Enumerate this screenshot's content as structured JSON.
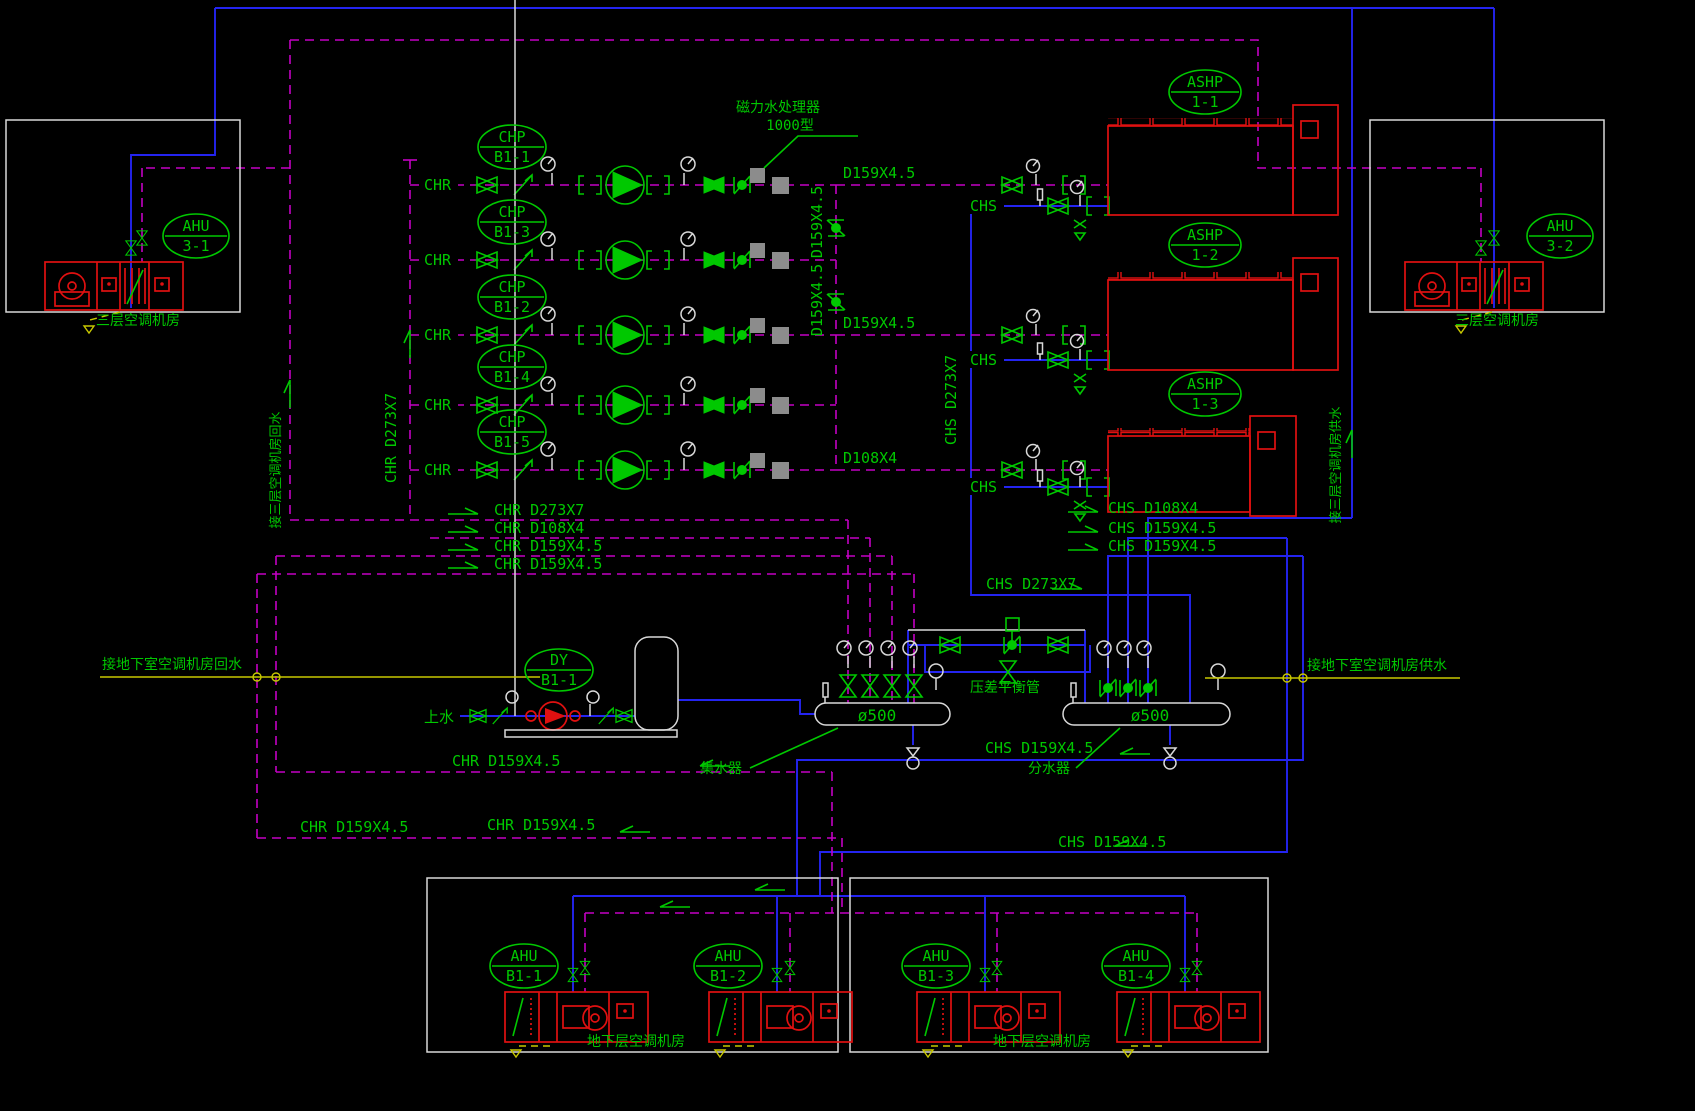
{
  "colors": {
    "background": "#000000",
    "return_pipe_chr": "#C400C4",
    "supply_pipe_chs": "#2424F0",
    "symbols_text": "#00C800",
    "equipment": "#E01010",
    "outline_white": "#D9D9D9",
    "drain_yellow": "#C8C800",
    "processor_gray": "#8C8C8C"
  },
  "tags": {
    "chp": [
      {
        "top": "CHP",
        "bot": "B1-1"
      },
      {
        "top": "CHP",
        "bot": "B1-3"
      },
      {
        "top": "CHP",
        "bot": "B1-2"
      },
      {
        "top": "CHP",
        "bot": "B1-4"
      },
      {
        "top": "CHP",
        "bot": "B1-5"
      }
    ],
    "ashp": [
      {
        "top": "ASHP",
        "bot": "1-1"
      },
      {
        "top": "ASHP",
        "bot": "1-2"
      },
      {
        "top": "ASHP",
        "bot": "1-3"
      }
    ],
    "ahu3": [
      {
        "top": "AHU",
        "bot": "3-1"
      },
      {
        "top": "AHU",
        "bot": "3-2"
      }
    ],
    "ahub": [
      {
        "top": "AHU",
        "bot": "B1-1"
      },
      {
        "top": "AHU",
        "bot": "B1-2"
      },
      {
        "top": "AHU",
        "bot": "B1-3"
      },
      {
        "top": "AHU",
        "bot": "B1-4"
      }
    ],
    "dy": {
      "top": "DY",
      "bot": "B1-1"
    }
  },
  "labels": {
    "chr": "CHR",
    "chs": "CHS",
    "row_size_1": "D159X4.5",
    "row_size_3": "D159X4.5",
    "row_size_5": "D108X4",
    "vert_size_a": "D159X4.5",
    "vert_size_b": "D159X4.5",
    "chr_main_vert": "CHR D273X7",
    "chs_main_vert": "CHS D273X7",
    "processor_1": "磁力水处理器",
    "processor_2": "1000型",
    "ret_3f": "接三层空调机房回水",
    "sup_3f": "接三层空调机房供水",
    "chr_gather_1": "CHR D273X7",
    "chr_gather_2": "CHR D108X4",
    "chr_gather_3": "CHR D159X4.5",
    "chr_gather_4": "CHR D159X4.5",
    "chs_gather_1": "CHS D108X4",
    "chs_gather_2": "CHS D159X4.5",
    "chs_gather_3": "CHS D159X4.5",
    "chs_main": "CHS D273X7",
    "ret_b1": "接地下室空调机房回水",
    "sup_b1": "接地下室空调机房供水",
    "makeup": "上水",
    "dia": "ø500",
    "collector": "集水器",
    "distributor": "分水器",
    "balance": "压差平衡管",
    "chr_b1_a": "CHR D159X4.5",
    "chr_b1_b": "CHR D159X4.5",
    "chr_b1_c": "CHR D159X4.5",
    "chs_b1_a": "CHS D159X4.5",
    "chs_b1_b": "CHS D159X4.5",
    "room_3f": "三层空调机房",
    "room_b1": "地下层空调机房"
  }
}
